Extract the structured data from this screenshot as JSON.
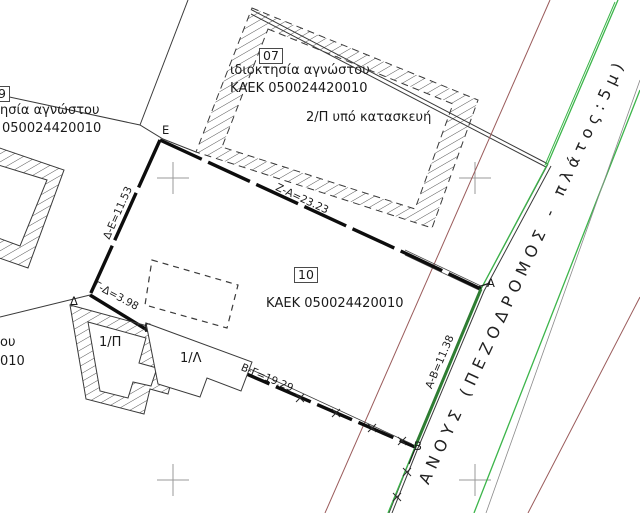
{
  "drawing": {
    "parcel_07": {
      "number": "07",
      "owner": "ιδιοκτησία αγνώστου",
      "kaek": "ΚΑΕΚ 050024420010",
      "building_note": "2/Π υπό κατασκευή"
    },
    "parcel_09": {
      "number": "9",
      "owner_fragment": "ησία αγνώστου",
      "kaek_fragment": "050024420010"
    },
    "parcel_10": {
      "number": "10",
      "kaek": "ΚΑΕΚ 050024420010"
    },
    "left_edge_fragments": {
      "line1": "ου",
      "line2": "010"
    },
    "buildings": {
      "b_1p": "1/Π",
      "b_1l": "1/Λ"
    },
    "points": {
      "a": "Α",
      "b": "Β",
      "g": "Γ",
      "d": "Δ",
      "e": "Ε"
    },
    "dimensions": {
      "za": "Ζ-Α=23.23",
      "de": "Δ-Ε=11.53",
      "gd": "Γ-Δ=3.98",
      "bg": "Β-Γ=19.29",
      "ab": "Α-Β=11.38"
    },
    "road_label": "ΑΝΟΥΣ (ΠΕΖΟΔΡΟΜΟΣ - πλάτος:5μ)",
    "colors": {
      "cadastral_green": "#3cb54a",
      "boundary_dark_green": "#2e7d32",
      "utility_line_brown": "#9a5b5b",
      "ink": "#1a1a1a",
      "grid_cross": "#9a9a9a"
    }
  }
}
